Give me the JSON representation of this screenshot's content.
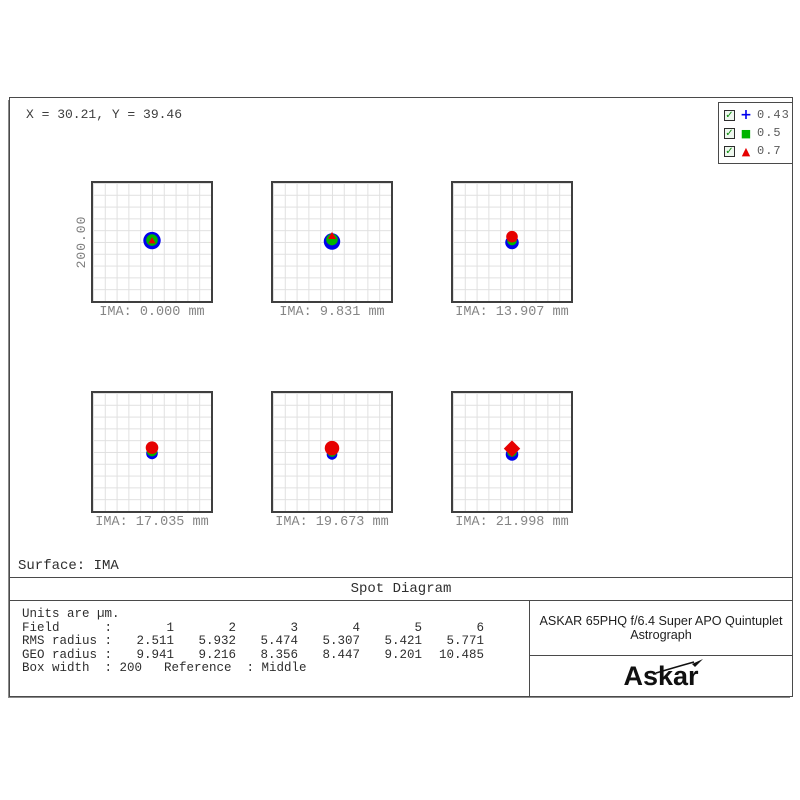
{
  "window": {
    "cursor_readout": "X = 30.21, Y = 39.46",
    "surface_label": "Surface: IMA",
    "title": "Spot Diagram"
  },
  "legend": {
    "check_glyph": "✓",
    "items": [
      {
        "wavelength": "0.43",
        "glyph": "+",
        "symbol": "plus-icon",
        "color": "#0000ee"
      },
      {
        "wavelength": "0.5",
        "glyph": "■",
        "symbol": "square-icon",
        "color": "#00b400"
      },
      {
        "wavelength": "0.7",
        "glyph": "▲",
        "symbol": "triangle-icon",
        "color": "#e60000"
      }
    ]
  },
  "colors": {
    "blue": "#0000ee",
    "green": "#00b400",
    "red": "#e60000",
    "grid_line": "#e0e0e0",
    "grid_border": "#3f3f3f"
  },
  "chart_data": {
    "type": "scatter",
    "subtype": "optical-spot-diagram",
    "title": "Spot Diagram",
    "units_note": "Units are µm.",
    "scale_bar_label": "200.00",
    "box_width_um": 200,
    "reference": "Middle",
    "wavelengths_um": [
      0.43,
      0.5,
      0.7
    ],
    "panels": [
      {
        "field": 1,
        "ima_label": "IMA: 0.000 mm",
        "ima_mm": 0.0,
        "rms_radius": 2.511,
        "geo_radius": 9.941,
        "spot_layers": [
          {
            "shape": "circle",
            "color": "blue",
            "dx": 0,
            "dy": 0.5,
            "r": 9
          },
          {
            "shape": "circle",
            "color": "green",
            "dx": 0,
            "dy": 0,
            "r": 6
          },
          {
            "shape": "triangle",
            "color": "red",
            "dx": 0,
            "dy": 0.5,
            "r": 3.5
          }
        ]
      },
      {
        "field": 2,
        "ima_label": "IMA: 9.831 mm",
        "ima_mm": 9.831,
        "rms_radius": 5.932,
        "geo_radius": 9.216,
        "spot_layers": [
          {
            "shape": "circle",
            "color": "blue",
            "dx": 0,
            "dy": 1.5,
            "r": 8.5
          },
          {
            "shape": "circle",
            "color": "green",
            "dx": 0,
            "dy": -0.5,
            "r": 6
          },
          {
            "shape": "triangle",
            "color": "red",
            "dx": 0,
            "dy": -4.5,
            "r": 4
          }
        ]
      },
      {
        "field": 3,
        "ima_label": "IMA: 13.907 mm",
        "ima_mm": 13.907,
        "rms_radius": 5.474,
        "geo_radius": 8.356,
        "spot_layers": [
          {
            "shape": "circle",
            "color": "blue",
            "dx": 0,
            "dy": 2.5,
            "r": 7
          },
          {
            "shape": "circle",
            "color": "green",
            "dx": 0,
            "dy": 0.5,
            "r": 5
          },
          {
            "shape": "circle",
            "color": "red",
            "dx": 0,
            "dy": -3.5,
            "r": 6
          }
        ]
      },
      {
        "field": 4,
        "ima_label": "IMA: 17.035 mm",
        "ima_mm": 17.035,
        "rms_radius": 5.307,
        "geo_radius": 8.447,
        "spot_layers": [
          {
            "shape": "circle",
            "color": "blue",
            "dx": 0,
            "dy": 3.5,
            "r": 6
          },
          {
            "shape": "circle",
            "color": "green",
            "dx": 0,
            "dy": 1,
            "r": 5.5
          },
          {
            "shape": "circle",
            "color": "red",
            "dx": 0,
            "dy": -2.5,
            "r": 6.5
          }
        ]
      },
      {
        "field": 5,
        "ima_label": "IMA: 19.673 mm",
        "ima_mm": 19.673,
        "rms_radius": 5.421,
        "geo_radius": 9.201,
        "spot_layers": [
          {
            "shape": "circle",
            "color": "blue",
            "dx": 0,
            "dy": 4.5,
            "r": 5.5
          },
          {
            "shape": "circle",
            "color": "green",
            "dx": 0,
            "dy": 2,
            "r": 5
          },
          {
            "shape": "circle",
            "color": "red",
            "dx": 0,
            "dy": -2,
            "r": 7.5
          }
        ]
      },
      {
        "field": 6,
        "ima_label": "IMA: 21.998 mm",
        "ima_mm": 21.998,
        "rms_radius": 5.771,
        "geo_radius": 10.485,
        "spot_layers": [
          {
            "shape": "circle",
            "color": "blue",
            "dx": 0,
            "dy": 4.5,
            "r": 6.5
          },
          {
            "shape": "circle",
            "color": "green",
            "dx": 0,
            "dy": 2,
            "r": 5
          },
          {
            "shape": "diamond",
            "color": "red",
            "dx": 0,
            "dy": -1.5,
            "r": 8.5
          }
        ]
      }
    ],
    "table": {
      "units_line": "Units are µm.",
      "rows": [
        {
          "label": "Field      :",
          "values": [
            "1",
            "2",
            "3",
            "4",
            "5",
            "6"
          ]
        },
        {
          "label": "RMS radius :",
          "values": [
            "2.511",
            "5.932",
            "5.474",
            "5.307",
            "5.421",
            "5.771"
          ]
        },
        {
          "label": "GEO radius :",
          "values": [
            "9.941",
            "9.216",
            "8.356",
            "8.447",
            "9.201",
            "10.485"
          ]
        }
      ],
      "box_row": {
        "label": "Box width  :",
        "value": " 200",
        "ref": "Reference  : Middle"
      }
    }
  },
  "footer": {
    "instrument": "ASKAR 65PHQ f/6.4 Super APO Quintuplet Astrograph",
    "brand": "Askar"
  }
}
